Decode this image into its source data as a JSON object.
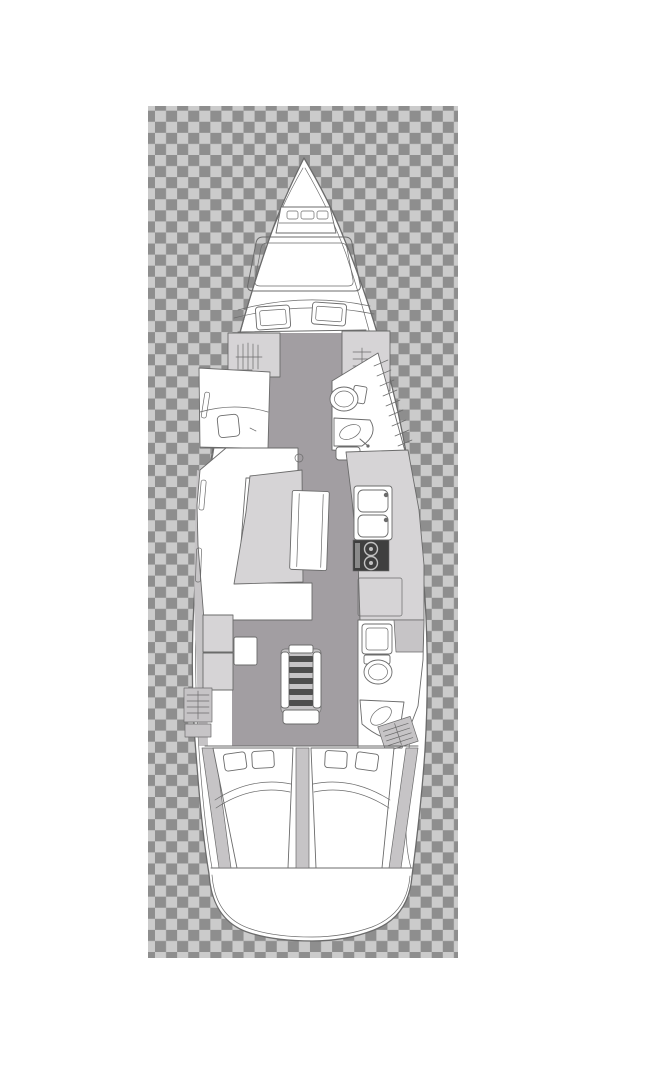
{
  "page": {
    "title": "Sailing yacht interior layout — overhead deck plan on transparent checkerboard"
  },
  "colors": {
    "page_bg": "#ffffff",
    "checker_light": "#cbcbcb",
    "checker_dark": "#8e8e8e",
    "outline": "#6b6b6b",
    "floor": "#a29ea2",
    "furniture": "#d6d4d6",
    "furniture_mid": "#c6c4c6",
    "stove": "#3f3f3f",
    "steps": "#4e4e4e",
    "white": "#ffffff"
  },
  "plan": {
    "vessel": "monohull-sailing-yacht-floor-plan",
    "regions": [
      {
        "name": "bow-anchor-locker"
      },
      {
        "name": "foredeck-hatches"
      },
      {
        "name": "forward-cabin-berth"
      },
      {
        "name": "forward-head"
      },
      {
        "name": "saloon-settee-and-table"
      },
      {
        "name": "galley"
      },
      {
        "name": "companionway-steps"
      },
      {
        "name": "port-cabinets-and-locker"
      },
      {
        "name": "aft-head"
      },
      {
        "name": "aft-cabin-port"
      },
      {
        "name": "aft-cabin-starboard"
      },
      {
        "name": "transom"
      }
    ],
    "icons": [
      "hanging-locker-icon",
      "toilet-icon",
      "corner-sink-icon",
      "shower-icon",
      "double-sink-icon",
      "stove-burners-icon",
      "stairs-icon",
      "pillow-icon",
      "saloon-table-icon",
      "deck-hatch-icon"
    ]
  }
}
